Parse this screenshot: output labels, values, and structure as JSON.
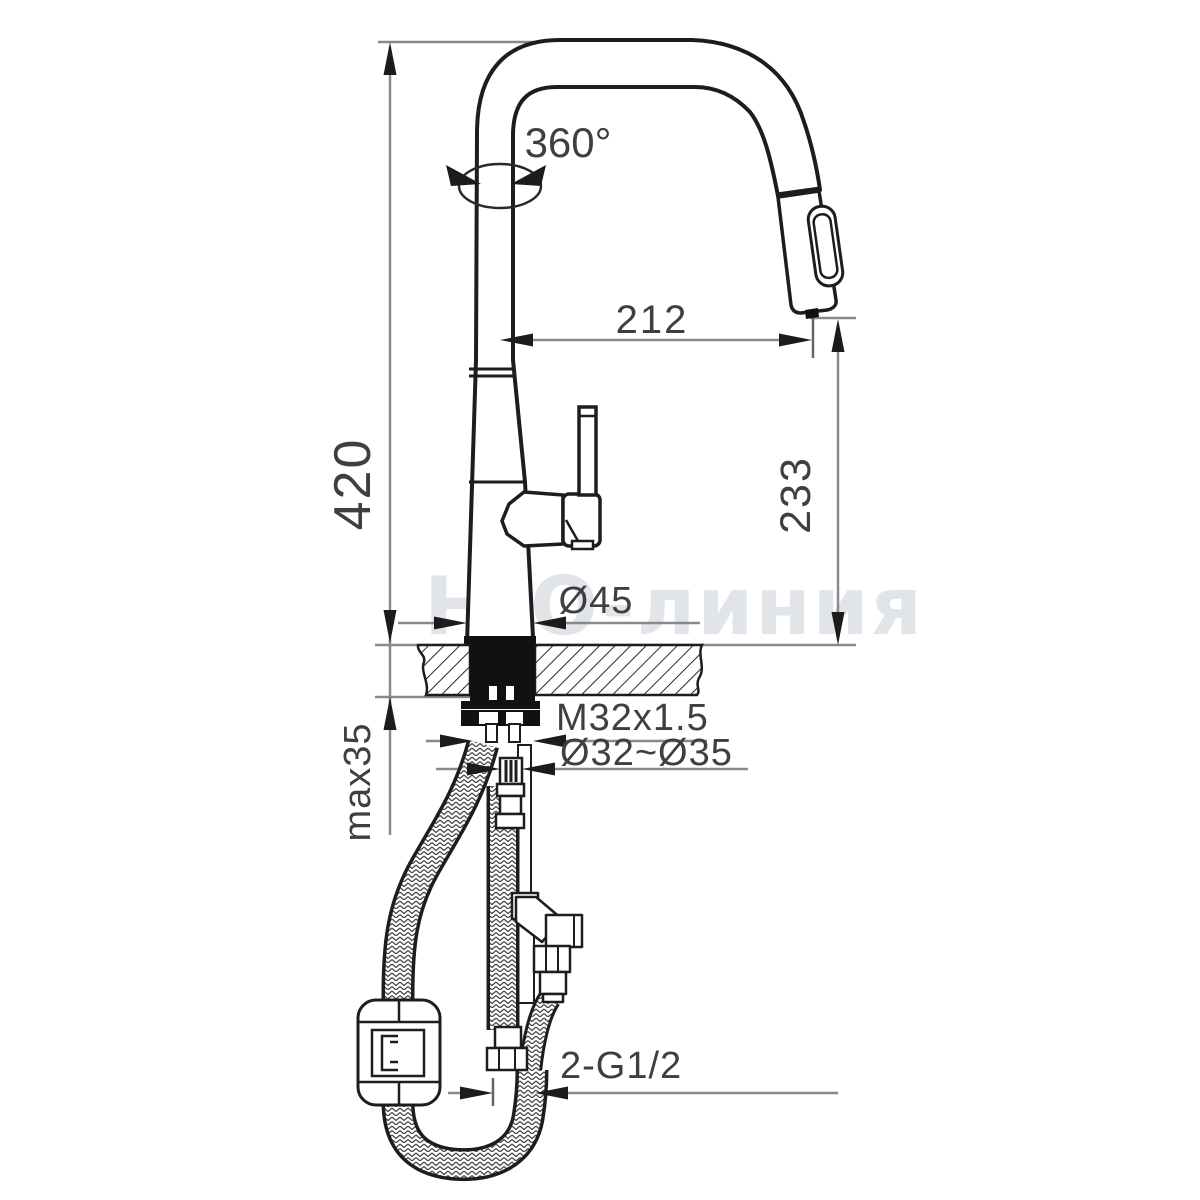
{
  "drawing": {
    "title_watermark": "H₂O-линия",
    "dimensions": {
      "total_height": "420",
      "spout_reach": "212",
      "outlet_height": "233",
      "swivel_angle": "360°",
      "base_diameter": "Ø45",
      "thread_spec": "M32x1.5",
      "mounting_hole": "Ø32~Ø35",
      "max_deck_thickness": "max35",
      "supply_connections": "2-G1/2"
    },
    "colors": {
      "outline": "#1d1d1d",
      "dimension_line": "#8a8a8a",
      "arrow": "#1c1c1c",
      "text": "#3f3f3f",
      "watermark": "#e1e4e8",
      "background": "#ffffff"
    }
  }
}
